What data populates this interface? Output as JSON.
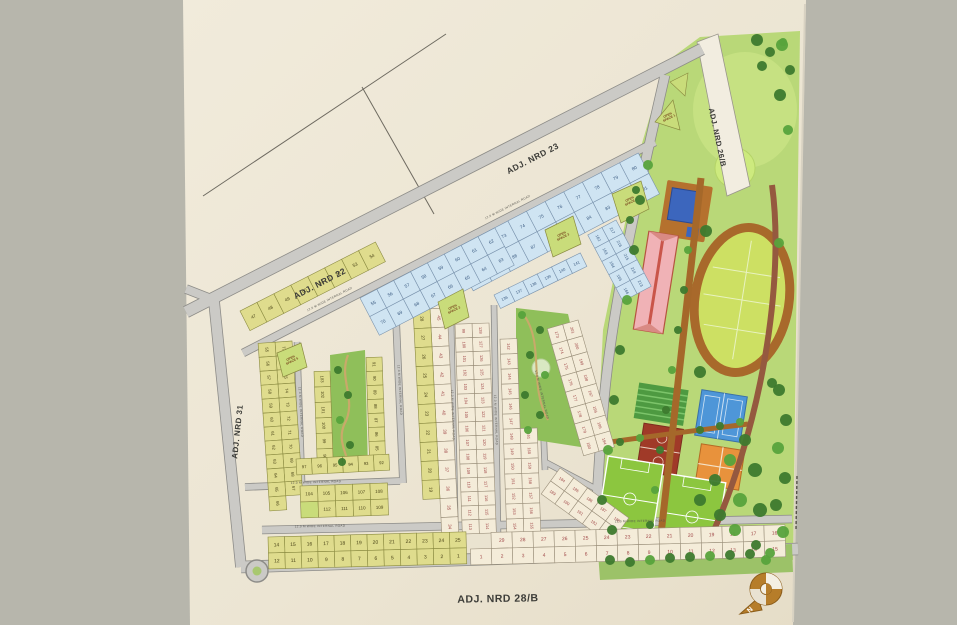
{
  "palette": {
    "background": "#b7b6ac",
    "paper": "#ece5d3",
    "paper_light": "#f1ebdb",
    "road": "#cbcac6",
    "road_edge": "#8d8c88",
    "yellow": "#dfdc8d",
    "yellow_line": "#8a8a40",
    "yellow_text": "#4a4418",
    "white": "#f4ecd9",
    "white_line": "#9a8f7a",
    "white_text": "#a04848",
    "blue": "#cfe4f2",
    "blue_line": "#7a93ad",
    "blue_text": "#3a5a80",
    "open_space": "#c9dc7a",
    "park_green": "#8fbf5a",
    "zone_green": "#b9d878",
    "lawn_green": "#cdea7e",
    "track_brown": "#a8692b",
    "infield_green": "#cde063",
    "pool_blue": "#3c66bd",
    "deck_brown": "#b5712e",
    "clubhouse_pink": "#f0b2b6",
    "clubhouse_red": "#c9554a",
    "tennis_blue": "#4e96d8",
    "court_orange": "#e8923c",
    "court_maroon": "#a03a28",
    "field_green": "#8cc63f",
    "tree_dark": "#3d7a2e",
    "tree_mid": "#57a33c",
    "path_brown": "#a5682a",
    "compass_gold": "#b67d2a"
  },
  "road_labels": [
    {
      "id": "nrd23",
      "text": "ADJ. NRD 23",
      "x": 534,
      "y": 161,
      "rot": -27.5,
      "size": 8.5
    },
    {
      "id": "nrd22",
      "text": "ADJ. NRD 22",
      "x": 321,
      "y": 286,
      "rot": -27.5,
      "size": 8.5
    },
    {
      "id": "nrd31",
      "text": "ADJ. NRD 31",
      "x": 240,
      "y": 432,
      "rot": -84,
      "size": 8
    },
    {
      "id": "nrd28b",
      "text": "ADJ. NRD 28/B",
      "x": 498,
      "y": 602,
      "rot": -1,
      "size": 10.5
    },
    {
      "id": "nrd26b",
      "text": "ADJ. NRD 26/B",
      "x": 715,
      "y": 138,
      "rot": 78,
      "size": 7.5
    }
  ],
  "internal_road_label": {
    "text": "12.0 M WIDE INTERNAL ROAD",
    "positions": [
      {
        "x": 320,
        "y": 527,
        "rot": -1
      },
      {
        "x": 640,
        "y": 522,
        "rot": -1
      },
      {
        "x": 316,
        "y": 483,
        "rot": -2
      },
      {
        "x": 300,
        "y": 412,
        "rot": 87
      },
      {
        "x": 399,
        "y": 390,
        "rot": 87
      },
      {
        "x": 452,
        "y": 415,
        "rot": 88
      },
      {
        "x": 495,
        "y": 420,
        "rot": 88
      },
      {
        "x": 541,
        "y": 395,
        "rot": 76
      },
      {
        "x": 330,
        "y": 300,
        "rot": -27
      },
      {
        "x": 508,
        "y": 208,
        "rot": -27
      }
    ]
  },
  "open_spaces": [
    {
      "label": "OPEN SPACE 1",
      "points": "655,122 673,100 680,130",
      "lx": 668,
      "ly": 116,
      "rot": -27
    },
    {
      "label": "OPEN SPACE 2",
      "points": "438,302 463,289 469,317 445,329",
      "lx": 453,
      "ly": 308,
      "rot": -27
    },
    {
      "label": "OPEN SPACE 3",
      "points": "545,230 573,216 581,244 553,257",
      "lx": 562,
      "ly": 235,
      "rot": -27
    },
    {
      "label": "OPEN SPACE 4",
      "points": "612,194 641,181 649,209 621,223",
      "lx": 630,
      "ly": 200,
      "rot": -27
    },
    {
      "label": "OPEN SPACE 5",
      "points": "277,353 301,343 307,367 283,377",
      "lx": 291,
      "ly": 359,
      "rot": -27
    }
  ],
  "blocks": [
    {
      "name": "yellow-top-row",
      "x": 240,
      "y": 311,
      "rot": -27,
      "cw": 19,
      "ch": 22,
      "fs": 4.5,
      "rows": [
        {
          "color": "yellow",
          "cells": [
            "47",
            "48",
            "49",
            "50",
            "51",
            "52",
            "53",
            "54"
          ]
        }
      ]
    },
    {
      "name": "yellow-pair-cols",
      "x": 292,
      "y": 341,
      "rot": 86,
      "cw": 14,
      "ch": 17,
      "fs": 4.2,
      "rows": [
        {
          "color": "yellow",
          "cells": [
            "77",
            "76",
            "75",
            "74",
            "73",
            "72",
            "71",
            "70",
            "69",
            "68",
            "67",
            null
          ]
        },
        {
          "color": "yellow",
          "cells": [
            "55",
            "56",
            "57",
            "58",
            "59",
            "60",
            "61",
            "62",
            "63",
            "64",
            "65",
            "66"
          ]
        }
      ]
    },
    {
      "name": "park-left-col",
      "x": 330,
      "y": 371,
      "rot": 88,
      "cw": 15.5,
      "ch": 16,
      "fs": 4.2,
      "rows": [
        {
          "color": "yellow",
          "cells": [
            "103",
            "102",
            "101",
            "100",
            "99",
            "98"
          ]
        }
      ]
    },
    {
      "name": "park-right-col",
      "x": 382,
      "y": 357,
      "rot": 88,
      "cw": 14,
      "ch": 16,
      "fs": 4.2,
      "rows": [
        {
          "color": "yellow",
          "cells": [
            "91",
            "90",
            "89",
            "88",
            "87",
            "86",
            "85",
            "84"
          ]
        }
      ]
    },
    {
      "name": "park-bottom-row",
      "x": 296,
      "y": 459,
      "rot": -3,
      "cw": 15.5,
      "ch": 16,
      "fs": 4.2,
      "rows": [
        {
          "color": "yellow",
          "cells": [
            "97",
            "96",
            "95",
            "94",
            "93",
            "92"
          ]
        }
      ]
    },
    {
      "name": "block-104",
      "x": 300,
      "y": 486,
      "rot": -2,
      "cw": 17.5,
      "ch": 16,
      "fs": 4.5,
      "rows": [
        {
          "color": "yellow",
          "cells": [
            "104",
            "105",
            "106",
            "107",
            "108"
          ]
        },
        {
          "color": "yellow",
          "cells": [
            "OS",
            "112",
            "111",
            "110",
            "109"
          ]
        }
      ]
    },
    {
      "name": "middle-pair-cols",
      "x": 446,
      "y": 289,
      "rot": 87,
      "cw": 19,
      "ch": 17,
      "fs": 4.5,
      "rows": [
        {
          "color": "white",
          "cells": [
            "46",
            "45",
            "44",
            "43",
            "42",
            "41",
            "40",
            "39",
            "38",
            "37",
            "36",
            "35",
            "34"
          ]
        },
        {
          "color": "yellow",
          "cells": [
            "29",
            "28",
            "27",
            "26",
            "25",
            "24",
            "23",
            "22",
            "21",
            "20",
            "19",
            null,
            null
          ]
        }
      ]
    },
    {
      "name": "center-col-1",
      "x": 489,
      "y": 323,
      "rot": 88,
      "cw": 14,
      "ch": 17,
      "fs": 4,
      "rows": [
        {
          "color": "white",
          "cells": [
            "128",
            "127",
            "126",
            "125",
            "124",
            "123",
            "122",
            "121",
            "120",
            "119",
            "118",
            "117",
            "116",
            "115",
            "114"
          ]
        },
        {
          "color": "white",
          "cells": [
            "99",
            "100",
            "101",
            "102",
            "103",
            "104",
            "105",
            "106",
            "107",
            "108",
            "109",
            "110",
            "111",
            "112",
            "113"
          ]
        }
      ]
    },
    {
      "name": "center-col-2",
      "x": 534,
      "y": 338,
      "rot": 88,
      "cw": 15,
      "ch": 17,
      "fs": 4,
      "rows": [
        {
          "color": "white",
          "cells": [
            null,
            null,
            null,
            null,
            null,
            null,
            "161",
            "160",
            "159",
            "158",
            "157",
            "156",
            "155"
          ]
        },
        {
          "color": "white",
          "cells": [
            "142",
            "143",
            "144",
            "145",
            "146",
            "147",
            "148",
            "149",
            "150",
            "151",
            "152",
            "153",
            "154"
          ]
        }
      ]
    },
    {
      "name": "blue-strip-a",
      "x": 452,
      "y": 250,
      "rot": -27.5,
      "cw": 21,
      "ch": 23,
      "fs": 4.5,
      "rows": [
        {
          "color": "blue",
          "cells": [
            "71",
            "72",
            "73",
            "74",
            "75",
            "76",
            "77",
            "78",
            "79",
            "80"
          ]
        },
        {
          "color": "blue",
          "cells": [
            "90",
            "89",
            "88",
            "87",
            "86",
            "85",
            "84",
            "83",
            "82",
            "81"
          ]
        }
      ]
    },
    {
      "name": "blue-strip-b",
      "x": 360,
      "y": 298,
      "rot": -27.5,
      "cw": 19,
      "ch": 21,
      "fs": 4.5,
      "rows": [
        {
          "color": "blue",
          "cells": [
            "55",
            "56",
            "57",
            "58",
            "59",
            "60",
            "61",
            "62"
          ]
        },
        {
          "color": "blue",
          "cells": [
            "70",
            "69",
            "68",
            "67",
            "66",
            "65",
            "64",
            "63"
          ]
        }
      ]
    },
    {
      "name": "blue-row-136",
      "x": 494,
      "y": 295,
      "rot": -26,
      "cw": 16,
      "ch": 15,
      "fs": 4,
      "rows": [
        {
          "color": "blue",
          "cells": [
            "136",
            "137",
            "138",
            "139",
            "140",
            "141"
          ]
        }
      ]
    },
    {
      "name": "blue-block-162",
      "x": 616,
      "y": 220,
      "rot": 62,
      "cw": 15,
      "ch": 16,
      "fs": 4,
      "rows": [
        {
          "color": "blue",
          "cells": [
            "217",
            "216",
            "215",
            "214",
            "213"
          ]
        },
        {
          "color": "blue",
          "cells": [
            "162",
            "163",
            "164",
            "165",
            "166"
          ]
        }
      ]
    },
    {
      "name": "right-strip",
      "x": 578,
      "y": 320,
      "rot": 74,
      "cw": 16.5,
      "ch": 16,
      "fs": 4,
      "rows": [
        {
          "color": "white",
          "cells": [
            "201",
            "200",
            "199",
            "198",
            "197",
            "196",
            "195",
            "194"
          ]
        },
        {
          "color": "white",
          "cells": [
            "173",
            "174",
            "175",
            "176",
            "177",
            "178",
            "179",
            "180"
          ]
        }
      ]
    },
    {
      "name": "fan-block",
      "x": 560,
      "y": 468,
      "rot": 36,
      "cw": 17,
      "ch": 16,
      "fs": 4,
      "rows": [
        {
          "color": "white",
          "cells": [
            "184",
            "185",
            "186",
            "187",
            "188"
          ]
        },
        {
          "color": "white",
          "cells": [
            "189",
            "190",
            "191",
            "192",
            "193"
          ]
        }
      ]
    },
    {
      "name": "bottom-yellow",
      "x": 268,
      "y": 537,
      "rot": -1.5,
      "cw": 16.5,
      "ch": 16,
      "fs": 5,
      "rows": [
        {
          "color": "yellow",
          "cells": [
            "14",
            "15",
            "16",
            "17",
            "18",
            "19",
            "20",
            "21",
            "22",
            "23",
            "24",
            "25"
          ]
        },
        {
          "color": "yellow",
          "cells": [
            "12",
            "11",
            "10",
            "9",
            "8",
            "7",
            "6",
            "5",
            "4",
            "3",
            "2",
            "1"
          ]
        }
      ]
    },
    {
      "name": "bottom-white",
      "x": 470,
      "y": 533,
      "rot": -1.5,
      "cw": 21,
      "ch": 16,
      "fs": 5,
      "rows": [
        {
          "color": "white",
          "cells": [
            null,
            "29",
            "28",
            "27",
            "26",
            "25",
            "24",
            "23",
            "22",
            "21",
            "20",
            "19",
            "18",
            "17",
            "16"
          ]
        },
        {
          "color": "white",
          "cells": [
            "1",
            "2",
            "3",
            "4",
            "5",
            "6",
            "7",
            "8",
            "9",
            "10",
            "11",
            "12",
            "13",
            "14",
            "15"
          ]
        }
      ]
    }
  ],
  "compass": {
    "north_label": "N"
  }
}
